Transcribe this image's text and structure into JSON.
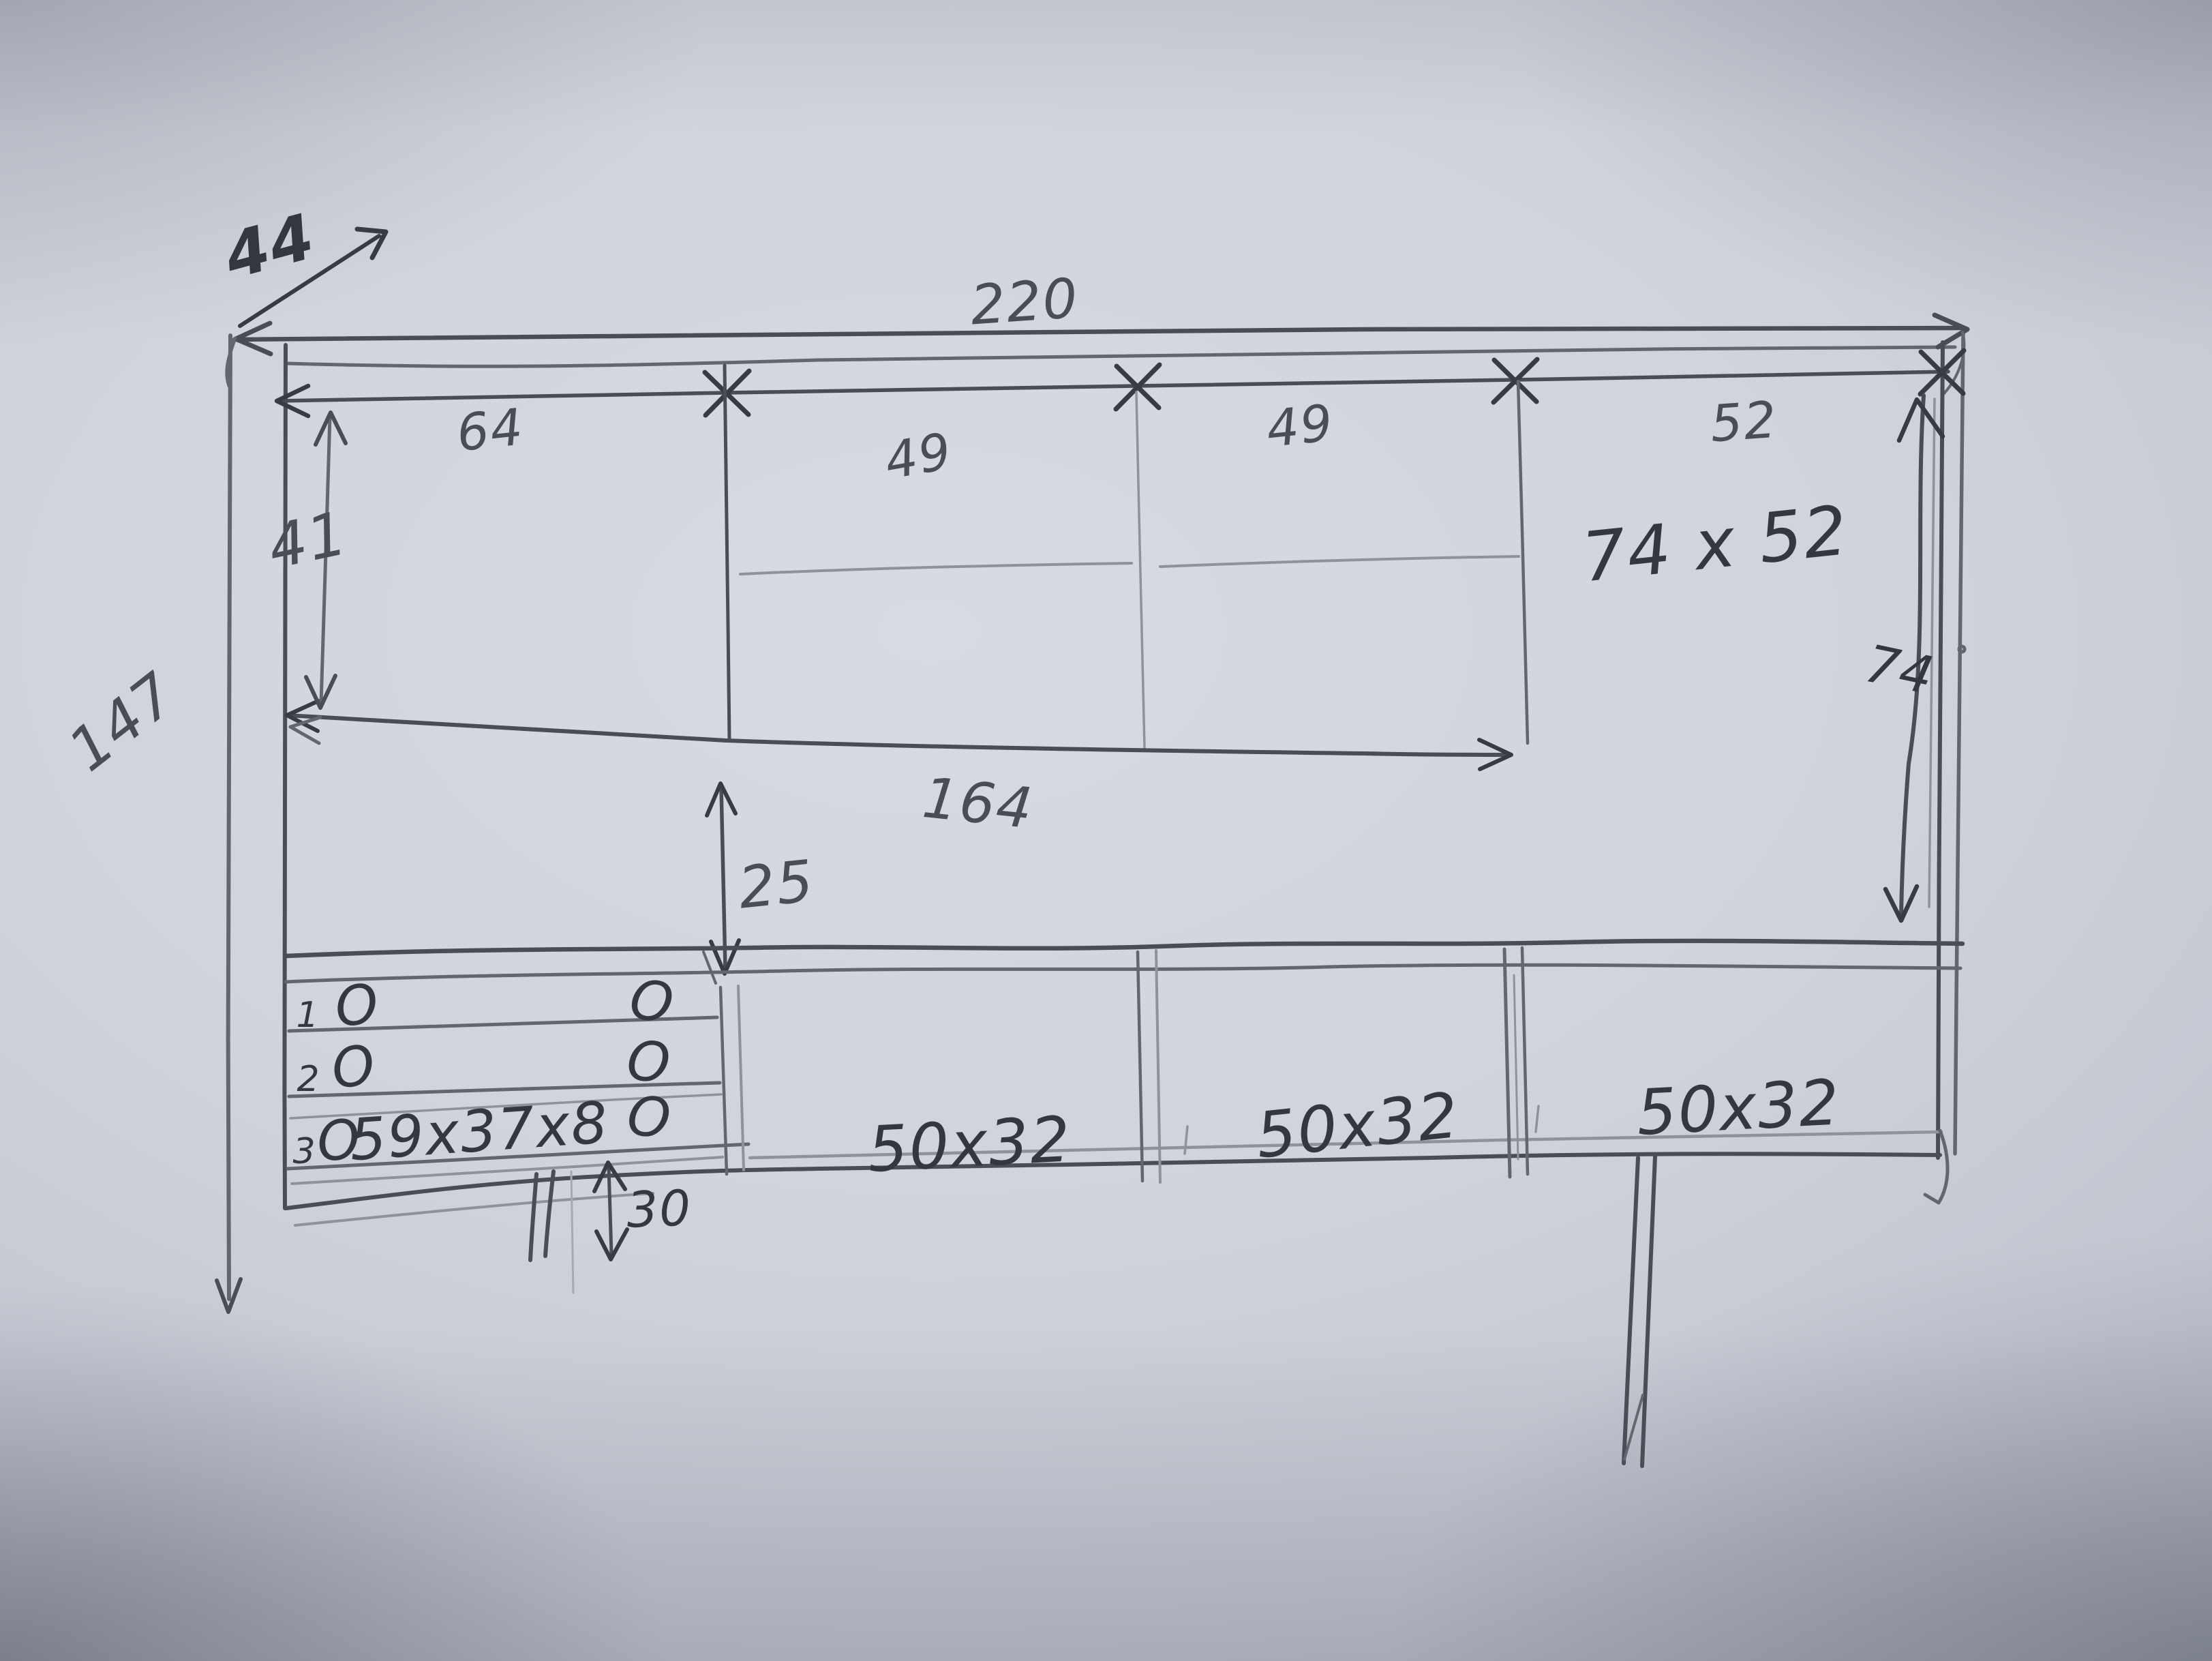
{
  "sketch": {
    "dims": {
      "depth": "44",
      "total_width": "220",
      "top_segments": [
        "64",
        "49",
        "49",
        "52"
      ],
      "upper_left_height": "41",
      "total_height": "147",
      "shelf_width": "164",
      "shelf_gap": "25",
      "right_compartment_size": "74 x 52",
      "right_inner_height": "74",
      "lower_compartment_sizes": [
        "50x32",
        "50x32",
        "50x32"
      ],
      "drawer_row_numbers": [
        "1",
        "2",
        "3"
      ],
      "knob_mark": "O",
      "drawer_size": "59x37x8",
      "plinth_height": "30"
    }
  }
}
